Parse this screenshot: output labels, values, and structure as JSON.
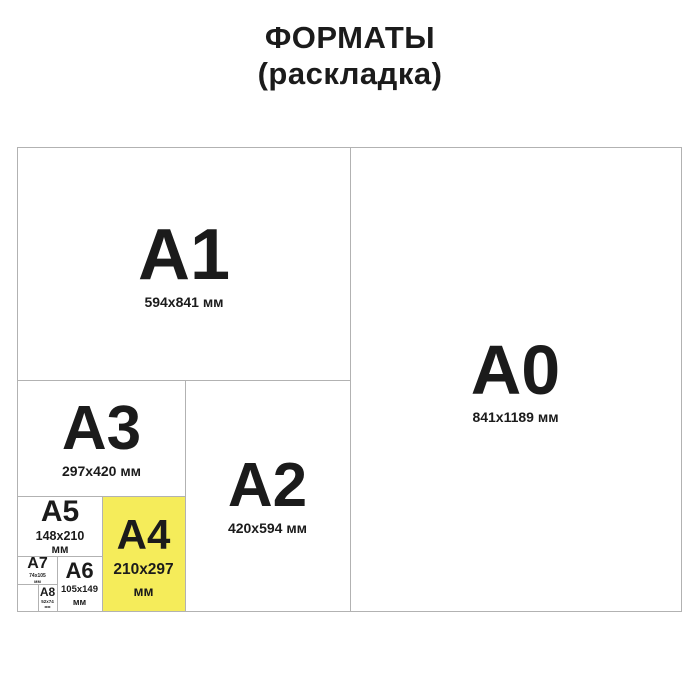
{
  "page": {
    "title_line1": "ФОРМАТЫ",
    "title_line2": "(раскладка)"
  },
  "colors": {
    "highlight_fill": "#f5ec5a",
    "border": "#b2b2b2",
    "text": "#1b1b1b",
    "background": "#ffffff"
  },
  "formats": {
    "a0": {
      "code": "A0",
      "dims": "841x1189 мм"
    },
    "a1": {
      "code": "A1",
      "dims": "594x841 мм"
    },
    "a2": {
      "code": "A2",
      "dims": "420x594 мм"
    },
    "a3": {
      "code": "A3",
      "dims": "297x420 мм"
    },
    "a4": {
      "code": "A4",
      "dims_line1": "210x297",
      "dims_line2": "мм",
      "highlighted": "true"
    },
    "a5": {
      "code": "A5",
      "dims_line1": "148x210",
      "dims_line2": "мм"
    },
    "a6": {
      "code": "A6",
      "dims_line1": "105x149",
      "dims_line2": "мм"
    },
    "a7": {
      "code": "A7",
      "dims_line1": "74x105",
      "dims_line2": "мм"
    },
    "a8": {
      "code": "A8",
      "dims_line1": "52x74",
      "dims_line2": "мм"
    }
  }
}
